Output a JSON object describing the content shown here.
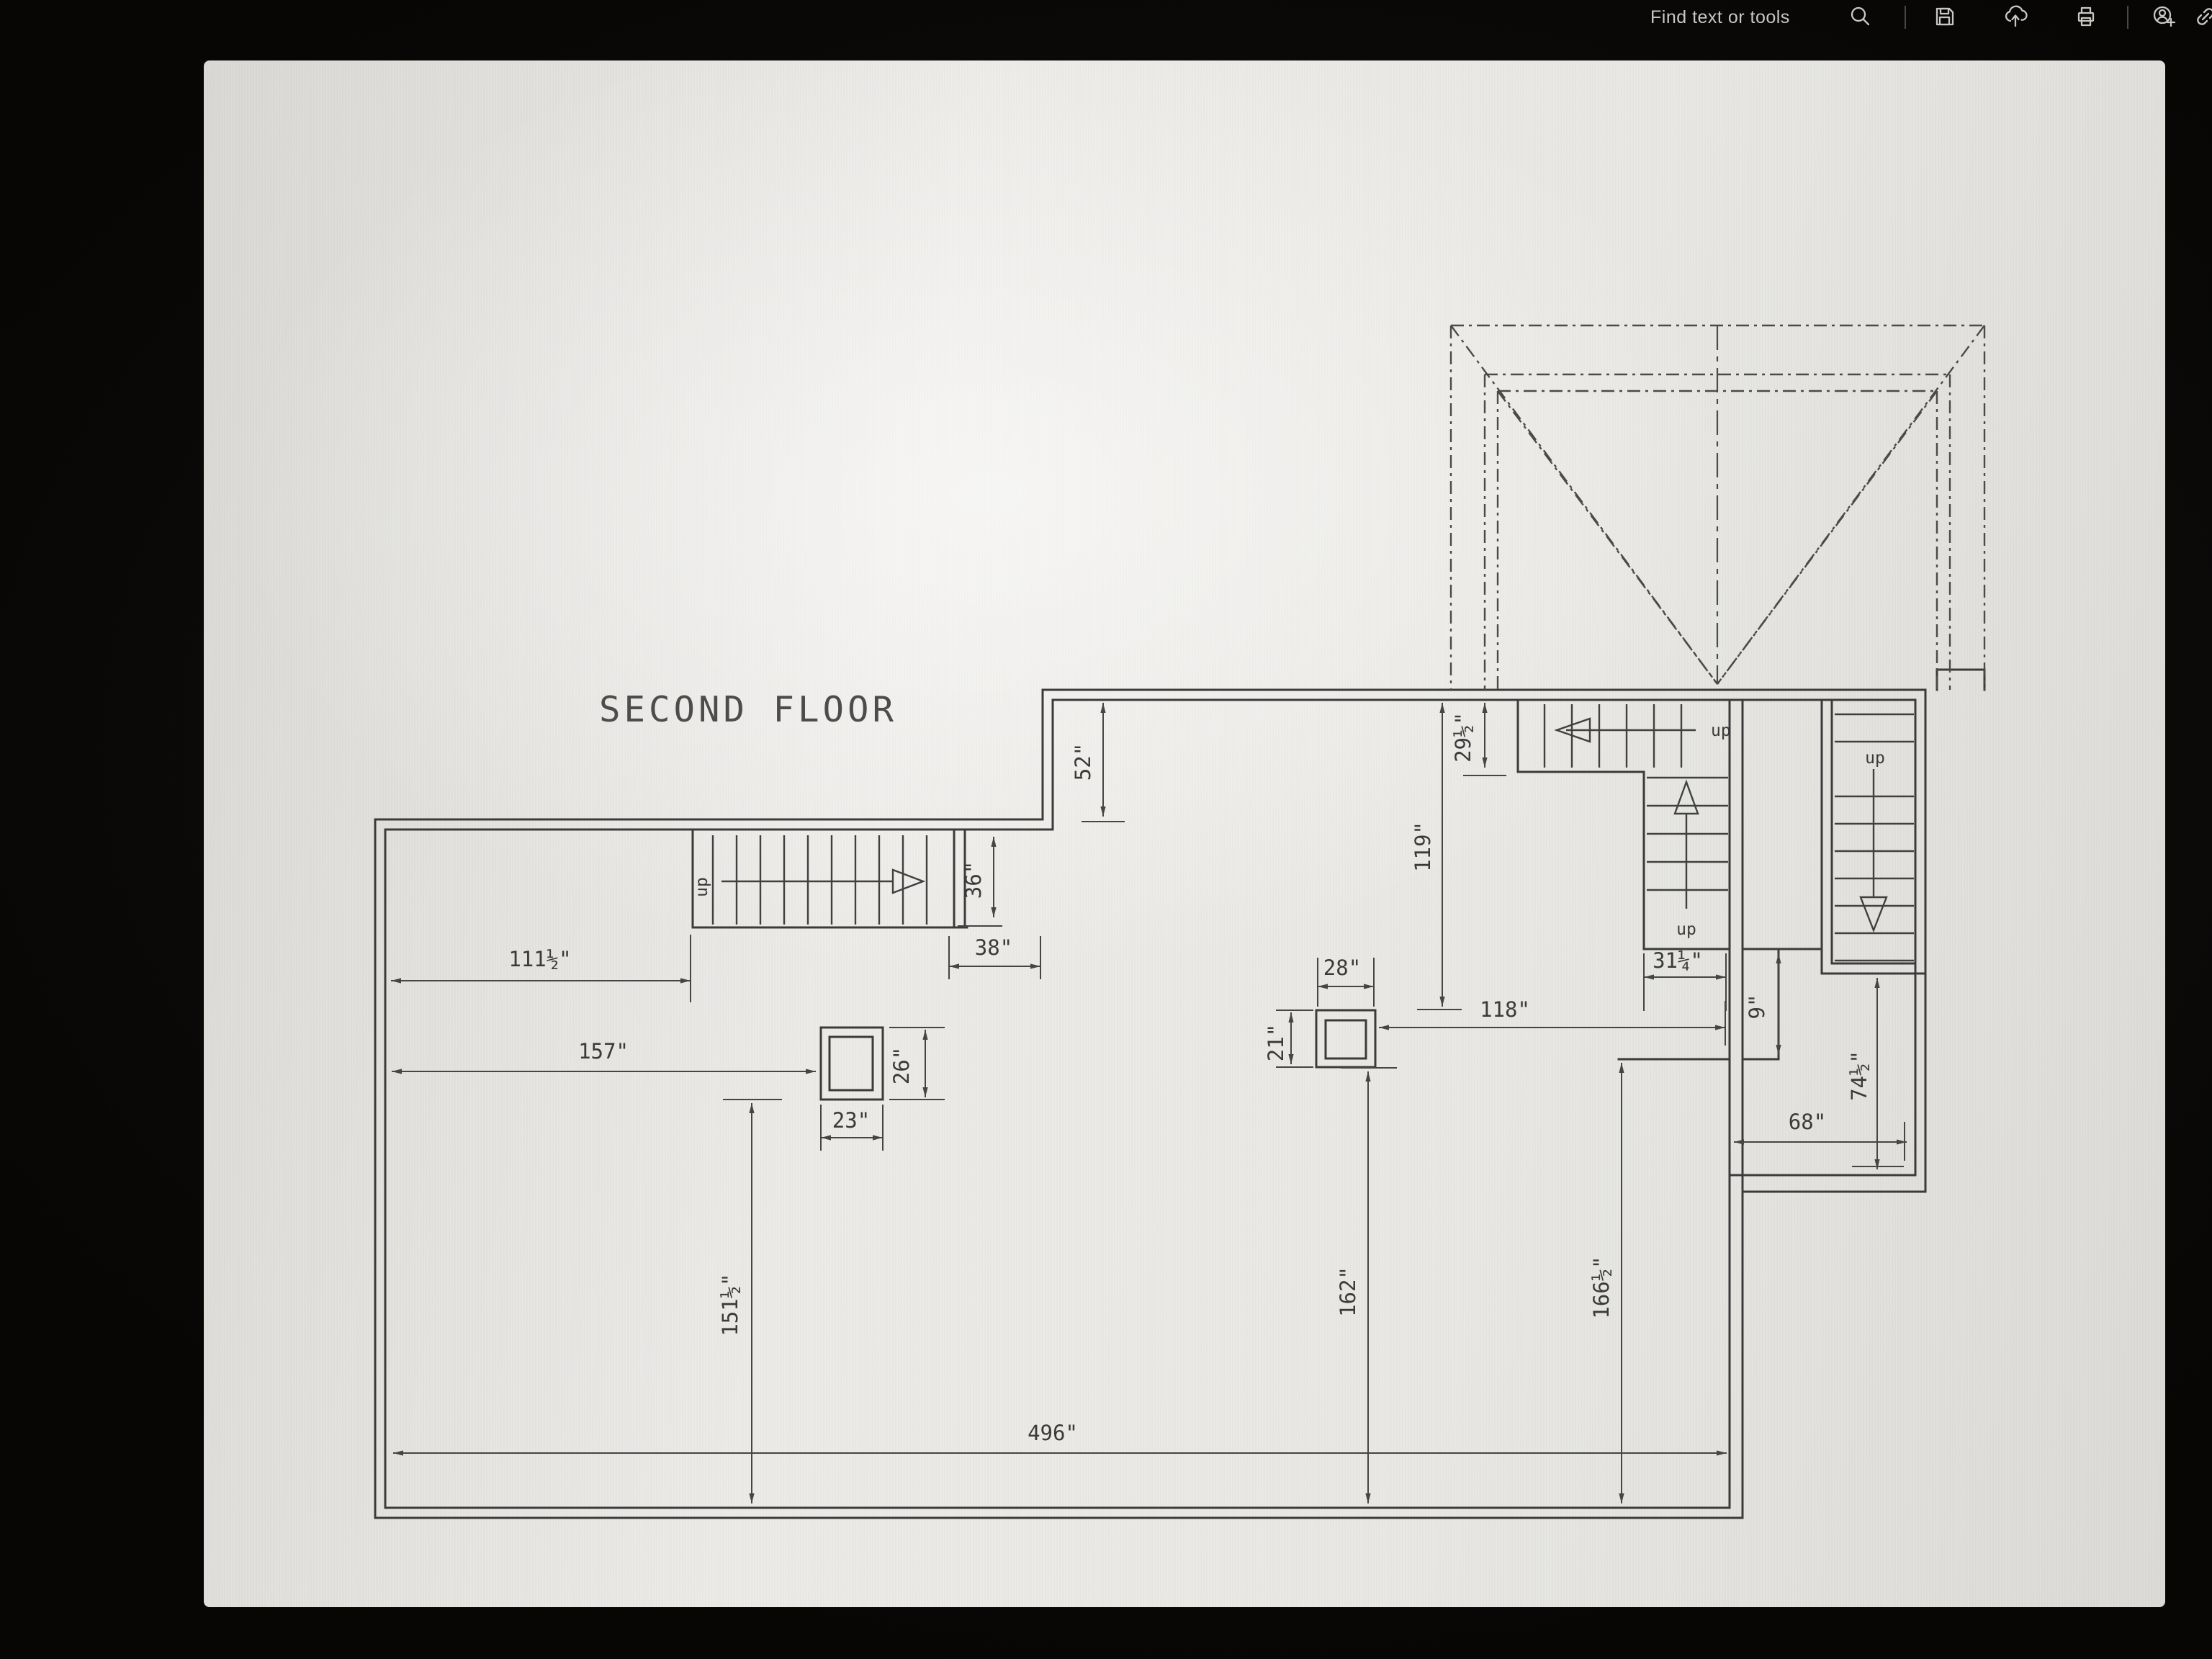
{
  "toolbar": {
    "find_label": "Find text or tools",
    "icons": [
      "search-icon",
      "save-icon",
      "share-icon",
      "print-icon",
      "add-person-icon",
      "link-icon"
    ]
  },
  "plan": {
    "title": "SECOND FLOOR",
    "stair_up_label": "up",
    "dims": {
      "d52": "52\"",
      "d36": "36\"",
      "d38": "38\"",
      "d111": "111½\"",
      "d157": "157\"",
      "d26": "26\"",
      "d23": "23\"",
      "d151": "151½\"",
      "d496": "496\"",
      "d162": "162\"",
      "d166": "166½\"",
      "d28": "28\"",
      "d21": "21\"",
      "d118": "118\"",
      "d119": "119\"",
      "d29": "29½\"",
      "d31": "31¼\"",
      "d9": "9\"",
      "d74": "74½\"",
      "d68": "68\""
    }
  },
  "colors": {
    "chrome_bg": "#0b0a08",
    "chrome_text": "#c9c7c3",
    "page_bg": "#e9e8e4",
    "line": "#3b3b3b"
  }
}
